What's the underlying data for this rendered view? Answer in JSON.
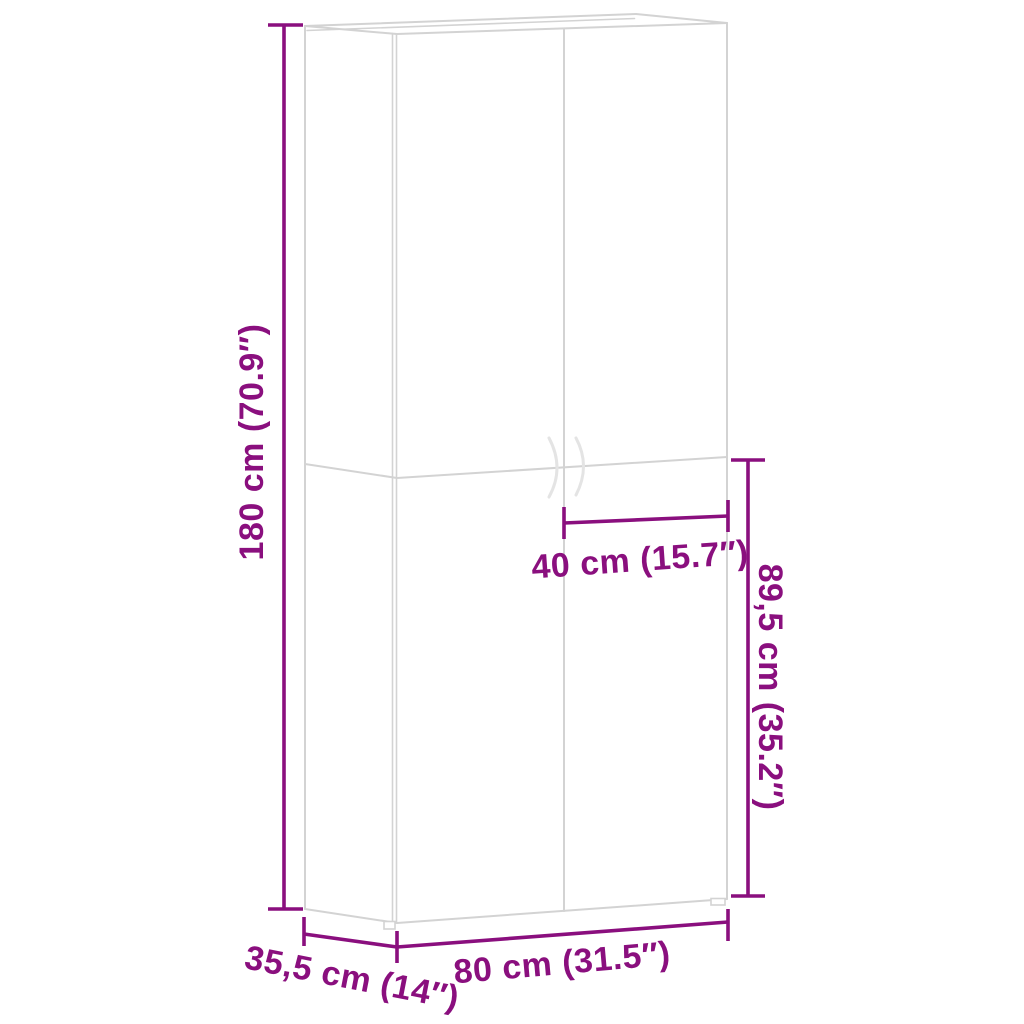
{
  "colors": {
    "accent": "#8A0F7E",
    "line": "#D3D3D3",
    "line-light": "#E4E4E4",
    "background": "#FFFFFF"
  },
  "dimensions": {
    "height": {
      "label": "180 cm (70.9″)"
    },
    "lower_section_height": {
      "label": "89,5 cm (35.2″)"
    },
    "door_width": {
      "label": "40 cm (15.7″)"
    },
    "width": {
      "label": "80 cm (31.5″)"
    },
    "depth": {
      "label": "35,5 cm (14″)"
    }
  }
}
